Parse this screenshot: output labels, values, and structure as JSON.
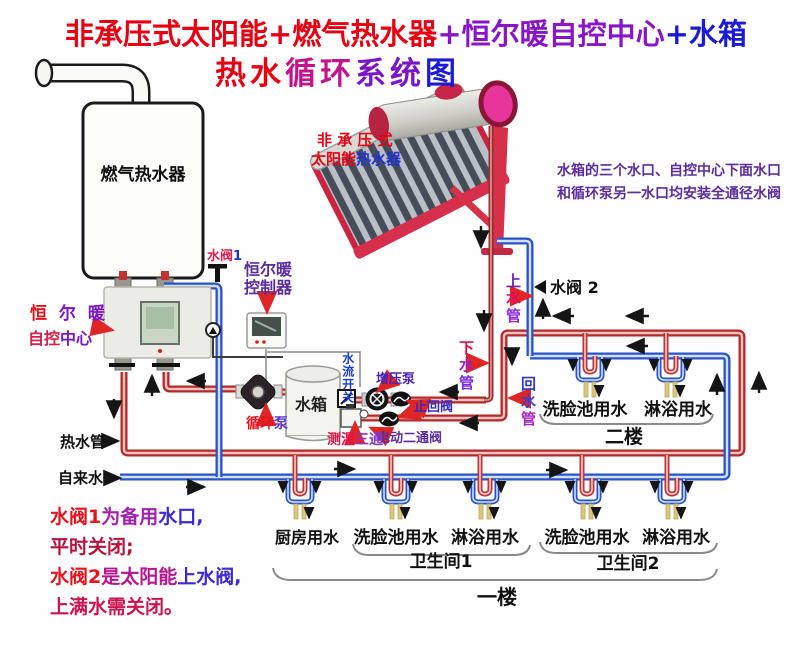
{
  "title": {
    "seg1": "非承压式太阳能+燃气热水器",
    "seg2": "+恒尔暖自控中心",
    "seg3": "+水箱",
    "sub1": "热水",
    "sub2": "循环",
    "sub3": "系统",
    "sub4": "图"
  },
  "solar": {
    "l1": "非 承 压 式",
    "l2a": "太阳能",
    "l2b": "热水器"
  },
  "gas_heater": "燃气热水器",
  "control_center": {
    "l1a": "恒 ",
    "l1b": "尔 暖",
    "l2a": "自控",
    "l2b": "中心"
  },
  "controller": {
    "l1": "恒尔暖",
    "l2": "控制器"
  },
  "tank": "水箱",
  "valve1": {
    "a": "水阀",
    "b": "1"
  },
  "valve2": "水阀 2",
  "pump": {
    "a": "循环",
    "b": "泵"
  },
  "booster": "增压泵",
  "check_valve": "止回阀",
  "flow_switch": "水流开关",
  "temp_tee": {
    "a": "测温",
    "b": "三通"
  },
  "motor_valve": "电动二通阀",
  "pipes": {
    "hot": "热水管",
    "tap": "自来水",
    "up": [
      "上",
      "水",
      "管"
    ],
    "down": [
      "下",
      "水",
      "管"
    ],
    "ret": [
      "回",
      "水",
      "管"
    ]
  },
  "notes": {
    "r1": "水箱的三个水口、自控中心下面水口",
    "r2": "和循环泵另一水口均安装全通径水阀",
    "b1a": "水阀1",
    "b1b": "为备用",
    "b1c": "水口,",
    "b2": "平时关闭;",
    "b3a": "水阀2",
    "b3b": "是太阳能",
    "b3c": "上水阀,",
    "b4": "上满水需关闭。"
  },
  "floor2": {
    "label": "二楼",
    "f1": "洗脸池用水",
    "f2": "淋浴用水"
  },
  "floor1": {
    "label": "一楼",
    "kitchen": "厨房用水",
    "bath1": "卫生间1",
    "b1f1": "洗脸池用水",
    "b1f2": "淋浴用水",
    "bath2": "卫生间2",
    "b2f1": "洗脸池用水",
    "b2f2": "淋浴用水"
  },
  "colors": {
    "hot": "#b52828",
    "cold": "#2a52c8",
    "title_red": "#e60012",
    "title_blue": "#1b1bd6",
    "purple": "#5b2d9b"
  }
}
